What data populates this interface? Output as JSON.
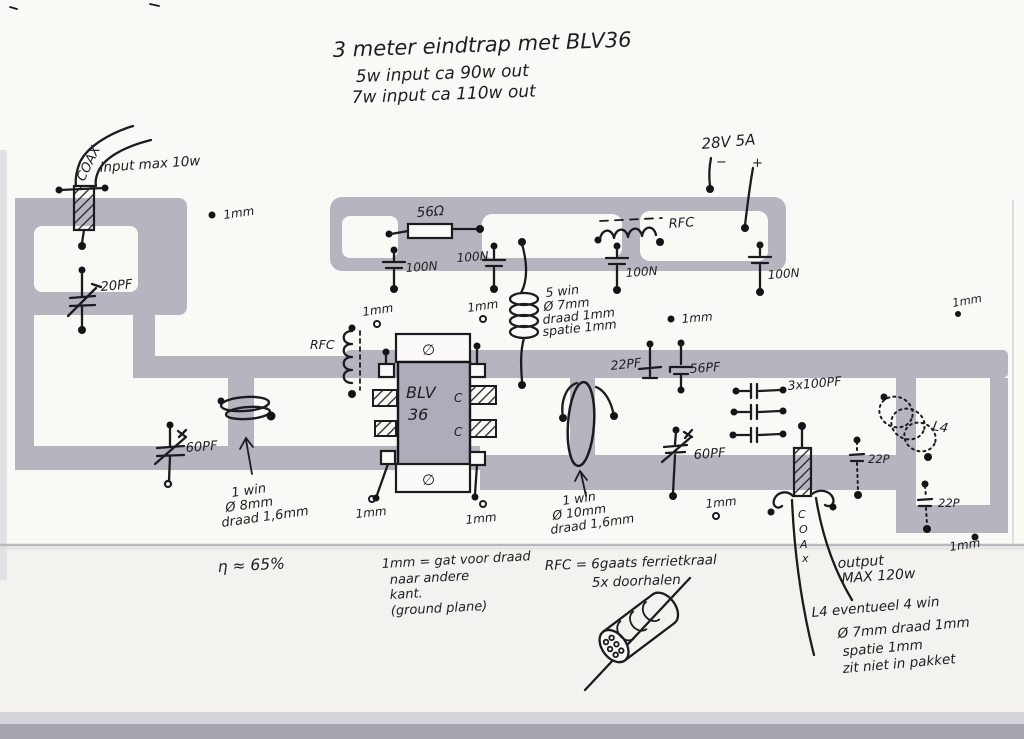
{
  "title": {
    "line1": "3 meter eindtrap met BLV36",
    "line2": "5w input ca 90w out",
    "line3": "7w input ca 110w out"
  },
  "input_coax": {
    "cable_label": "COAX",
    "note": "input max 10w"
  },
  "supply": {
    "rating": "28V 5A",
    "minus": "−",
    "plus": "+"
  },
  "top_band": {
    "r1": "56Ω",
    "c1": "100N",
    "c2": "100N",
    "c3": "100N",
    "c4": "100N",
    "rfc_label": "RFC"
  },
  "transistor": {
    "name_line1": "BLV",
    "name_line2": "36",
    "pin_c_upper": "C",
    "pin_c_lower": "C",
    "screw_top": "∅",
    "screw_bottom": "∅",
    "rfc_label": "RFC"
  },
  "caps": {
    "c20": "20PF",
    "c60_left": "60PF",
    "c60_right": "60PF",
    "c22pf": "22PF",
    "c56pf": "56PF",
    "c3x100": "3x100PF",
    "c22p_upper": "22P",
    "c22p_lower": "22P"
  },
  "coils": {
    "input_loop": [
      "1 win",
      "Ø 8mm",
      "draad 1,6mm"
    ],
    "interstage": [
      "5 win",
      "Ø 7mm",
      "draad 1mm",
      "spatie 1mm"
    ],
    "output_loop": [
      "1 win",
      "Ø 10mm",
      "draad 1,6mm"
    ],
    "l4_label": "L4"
  },
  "holes": {
    "label": "1mm"
  },
  "output": {
    "cable_letters": [
      "C",
      "O",
      "A",
      "x"
    ],
    "note_line1": "output",
    "note_line2": "MAX 120w"
  },
  "notes": {
    "efficiency": "η ≈ 65%",
    "hole_note": [
      "1mm = gat voor draad",
      "naar andere",
      "kant.",
      "(ground plane)"
    ],
    "rfc_note": [
      "RFC = 6gaats ferrietkraal",
      "5x doorhalen"
    ],
    "l4_note": [
      "L4 eventueel 4 win",
      "Ø 7mm draad 1mm",
      "spatie 1mm",
      "zit niet in pakket"
    ]
  }
}
